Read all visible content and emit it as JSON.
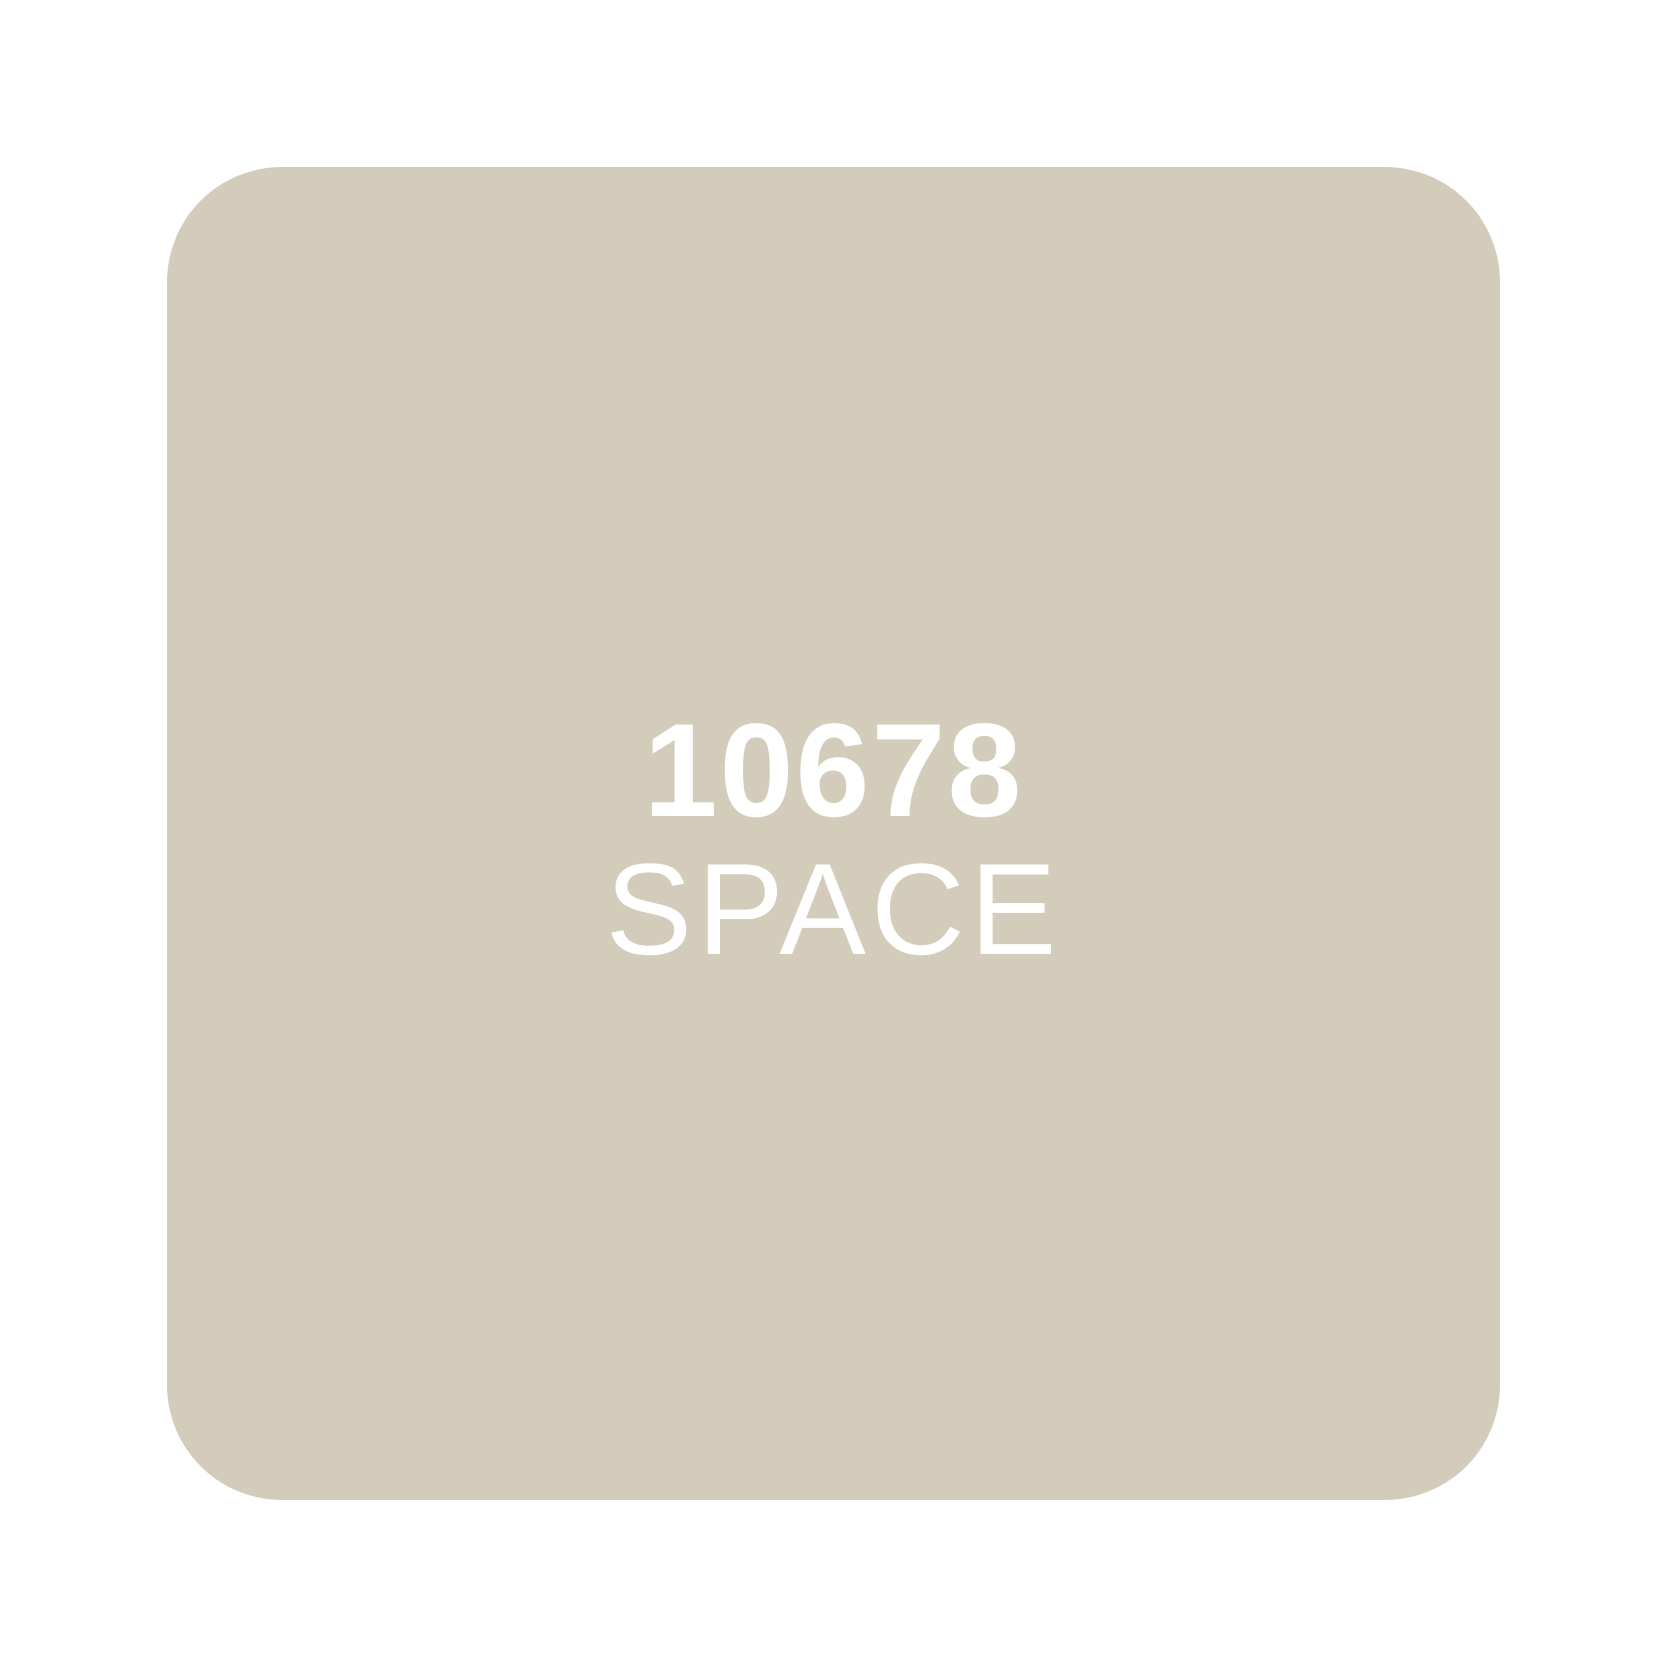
{
  "page": {
    "background_color": "#ffffff"
  },
  "swatch": {
    "code": "10678",
    "name": "SPACE",
    "fill_color": "#d3ccbb",
    "text_color": "#ffffff",
    "shape": "rounded-square"
  }
}
